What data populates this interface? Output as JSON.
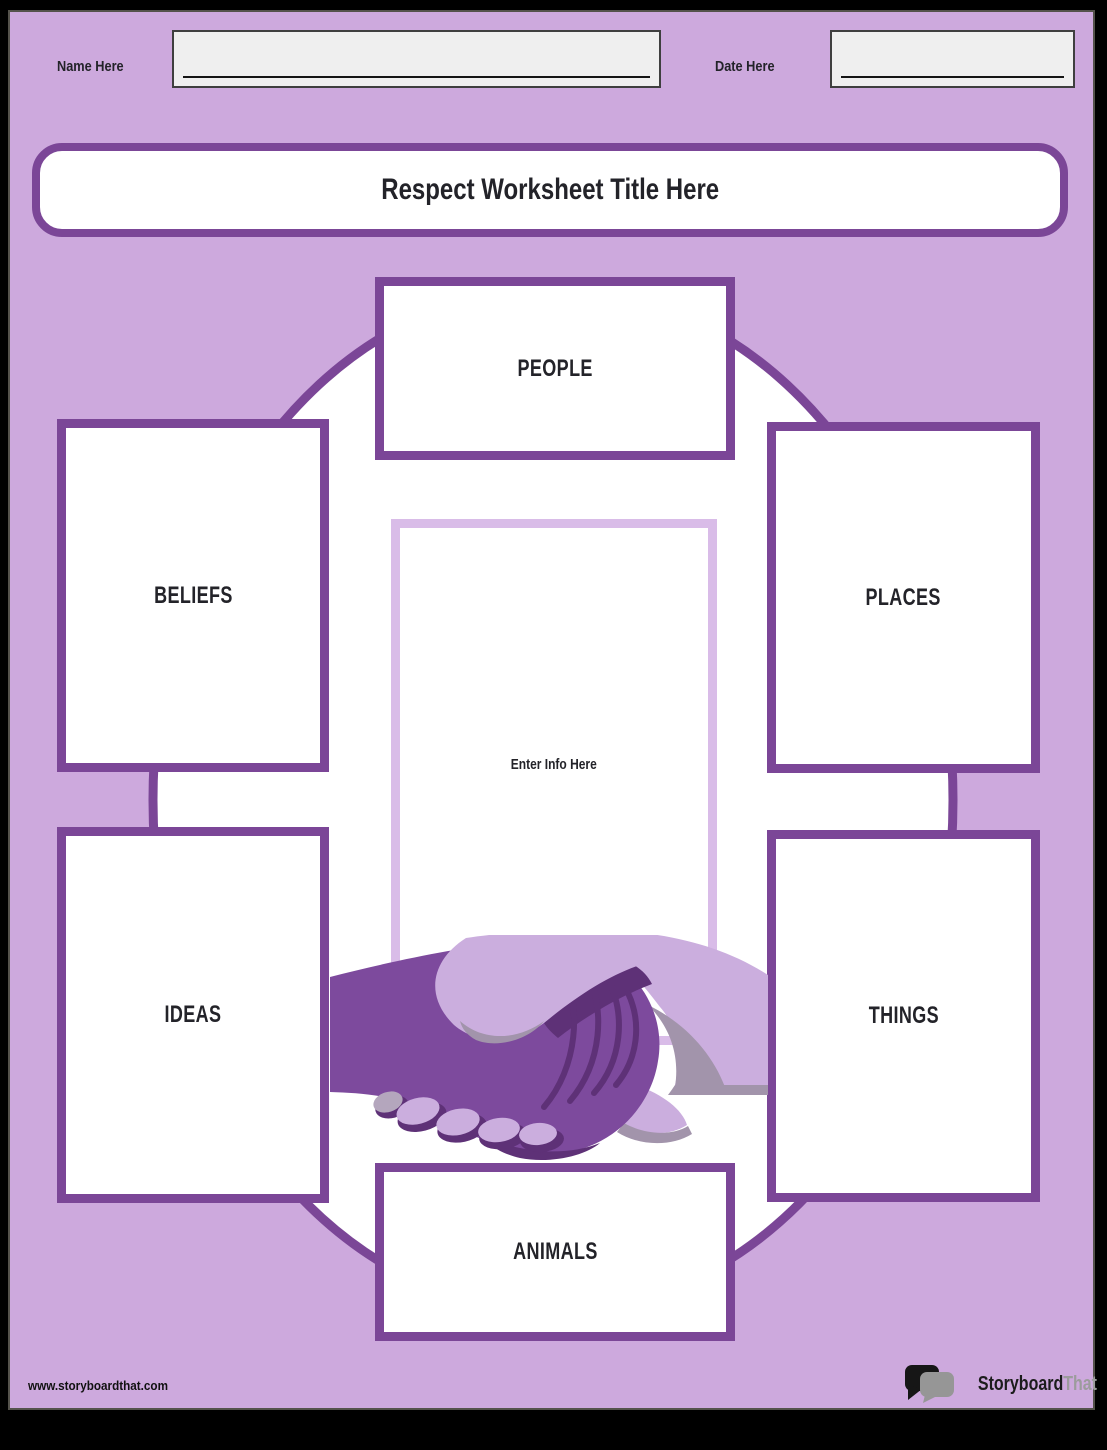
{
  "colors": {
    "page_background": "#cda9dd",
    "frame": "#000000",
    "accent_purple": "#7b4697",
    "center_box_border": "#d9bce8",
    "text_dark": "#232329",
    "input_fill": "#efefef",
    "arm_dark": "#7d4a9d",
    "arm_light": "#cbaede",
    "shadow_dark": "#5e3177",
    "shadow_gray": "#a294ab"
  },
  "header": {
    "name_label": "Name Here",
    "name_value": "",
    "date_label": "Date Here",
    "date_value": ""
  },
  "title": {
    "text": "Respect Worksheet Title Here"
  },
  "diagram": {
    "center_placeholder": "Enter Info Here",
    "illustration": "handshake-icon",
    "categories": [
      {
        "label": "PEOPLE"
      },
      {
        "label": "BELIEFS"
      },
      {
        "label": "PLACES"
      },
      {
        "label": "IDEAS"
      },
      {
        "label": "THINGS"
      },
      {
        "label": "ANIMALS"
      }
    ]
  },
  "footer": {
    "website": "www.storyboardthat.com",
    "logo_primary": "Storyboard",
    "logo_secondary": "That"
  }
}
